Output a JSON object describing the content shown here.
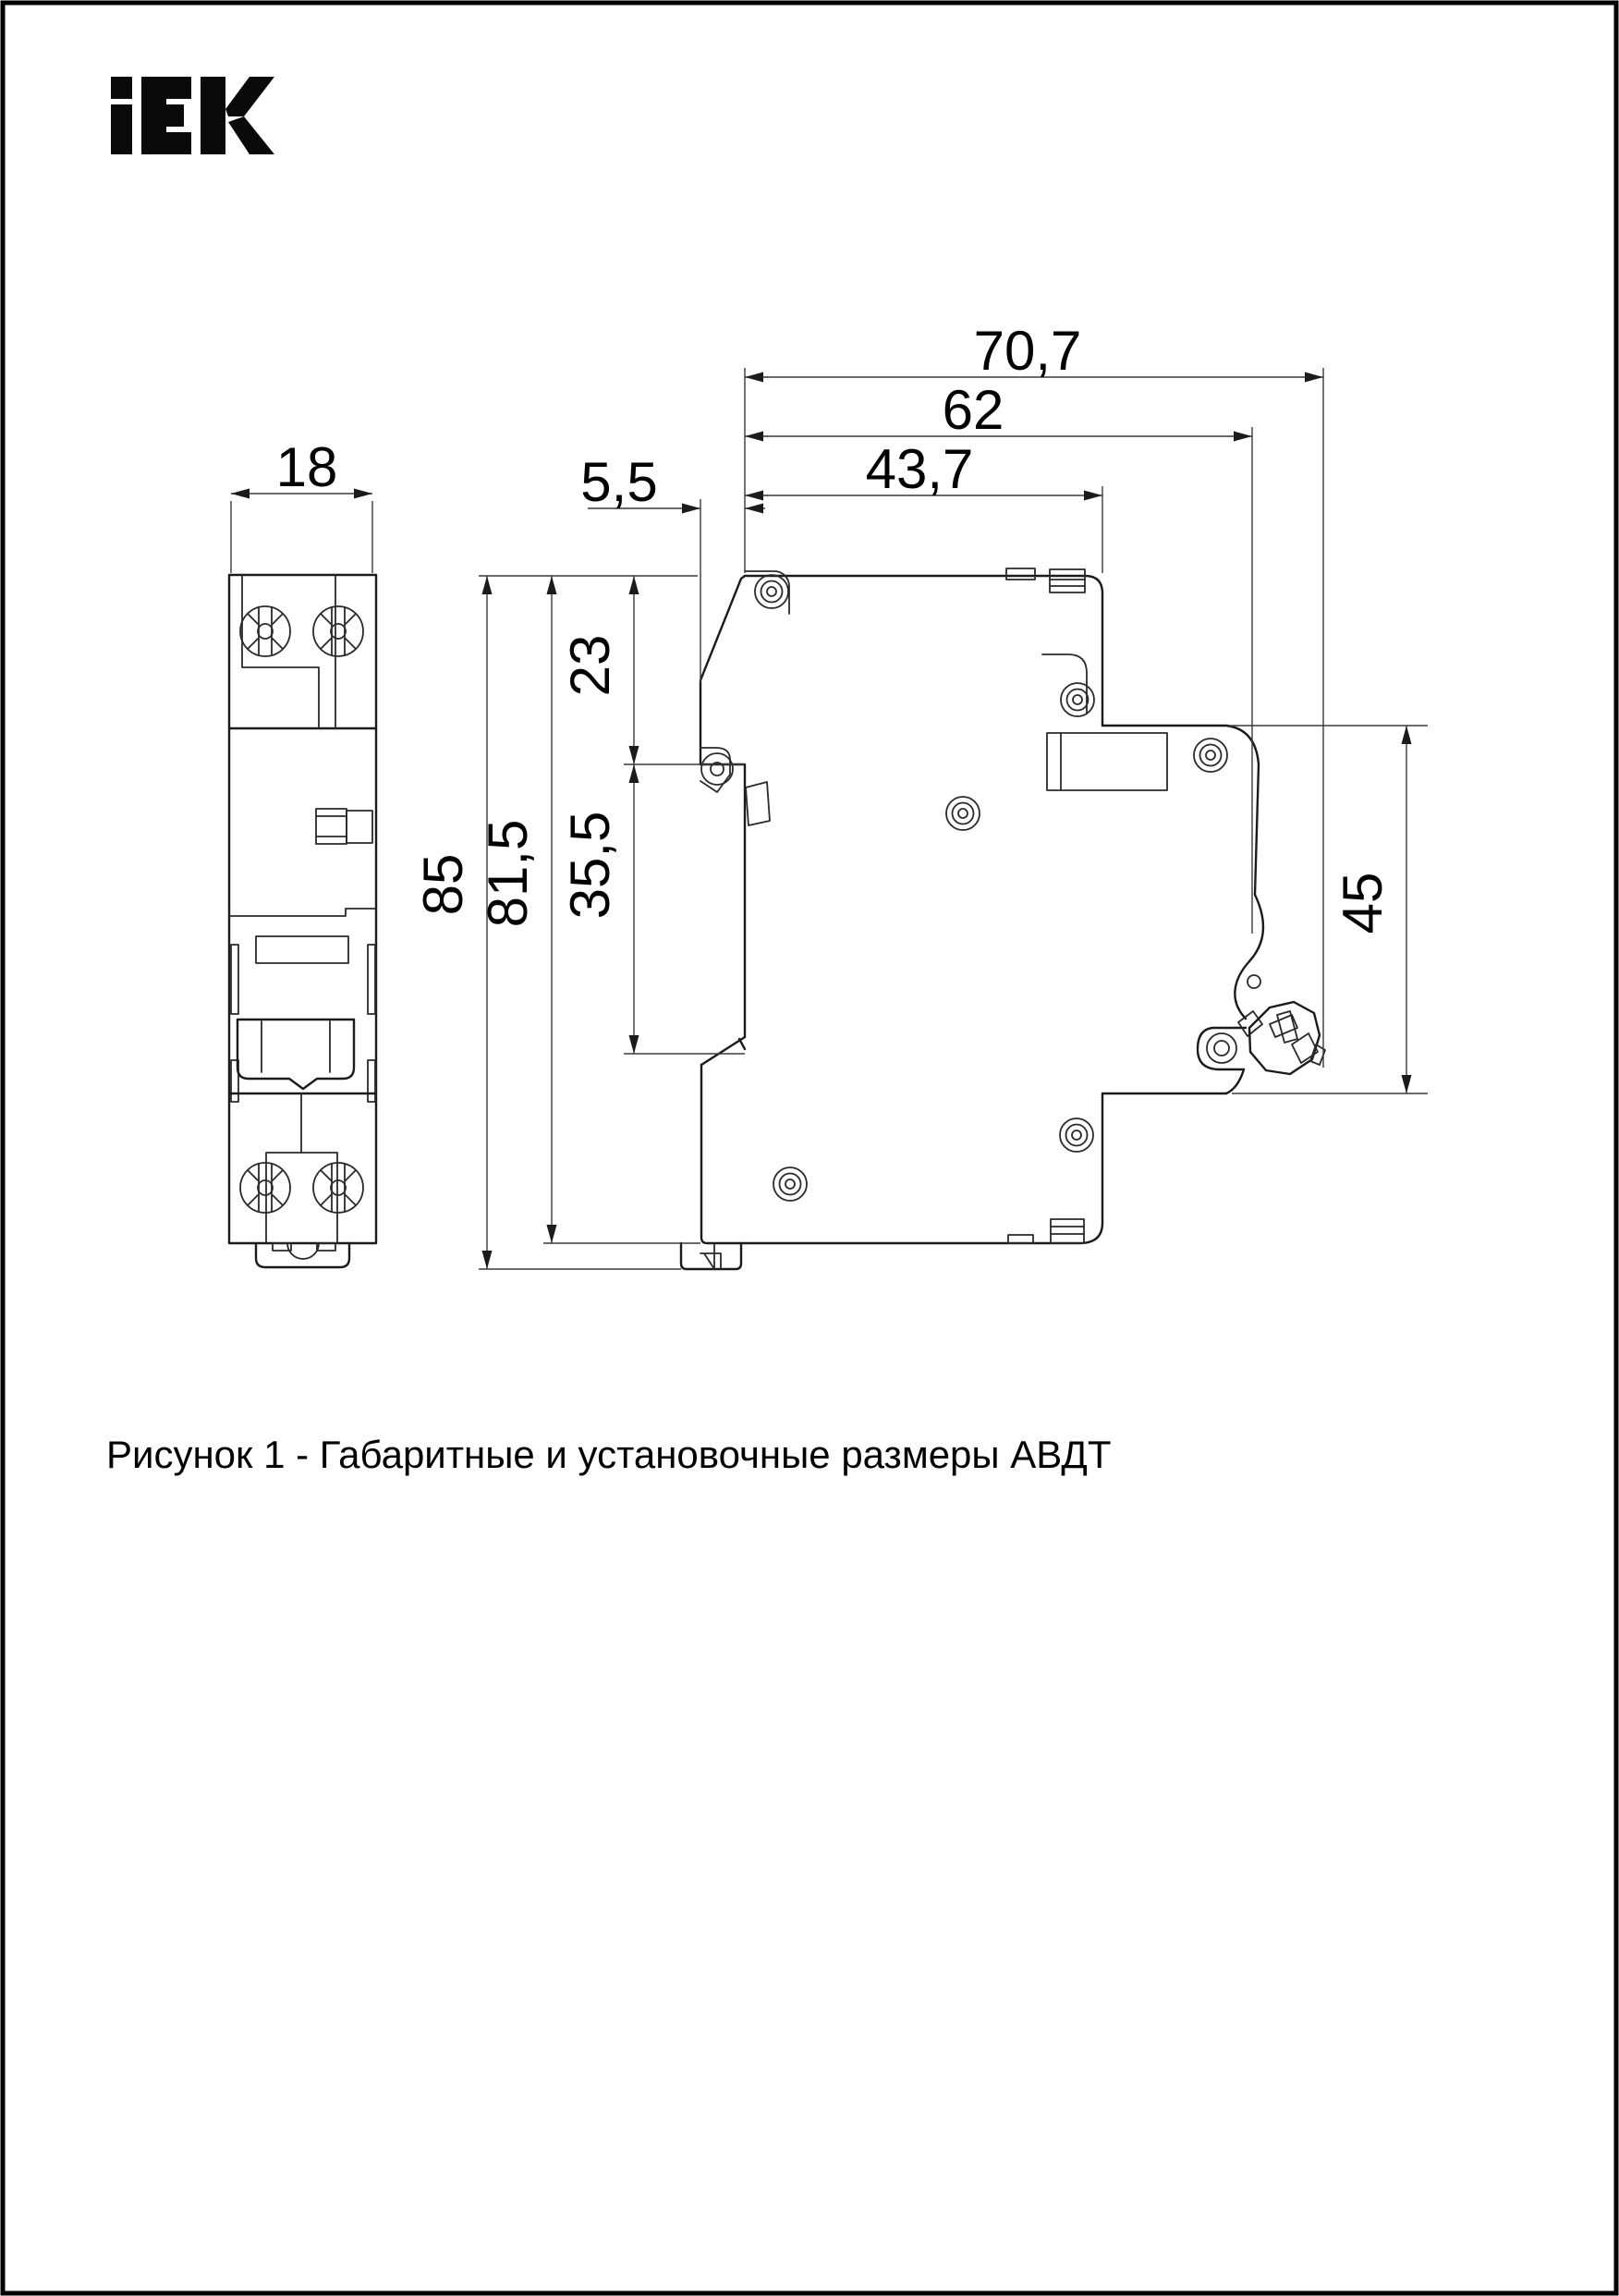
{
  "logo": {
    "text": "IEK"
  },
  "caption": "Рисунок 1 - Габаритные и установочные размеры АВДТ",
  "dimensions": {
    "front_width": "18",
    "overall_depth": "70,7",
    "depth_to_latch": "62",
    "upper_body_depth": "43,7",
    "front_ledge": "5,5",
    "total_height": "85",
    "body_height": "81,5",
    "upper_section": "23",
    "mid_section": "35,5",
    "din_rail": "45"
  }
}
